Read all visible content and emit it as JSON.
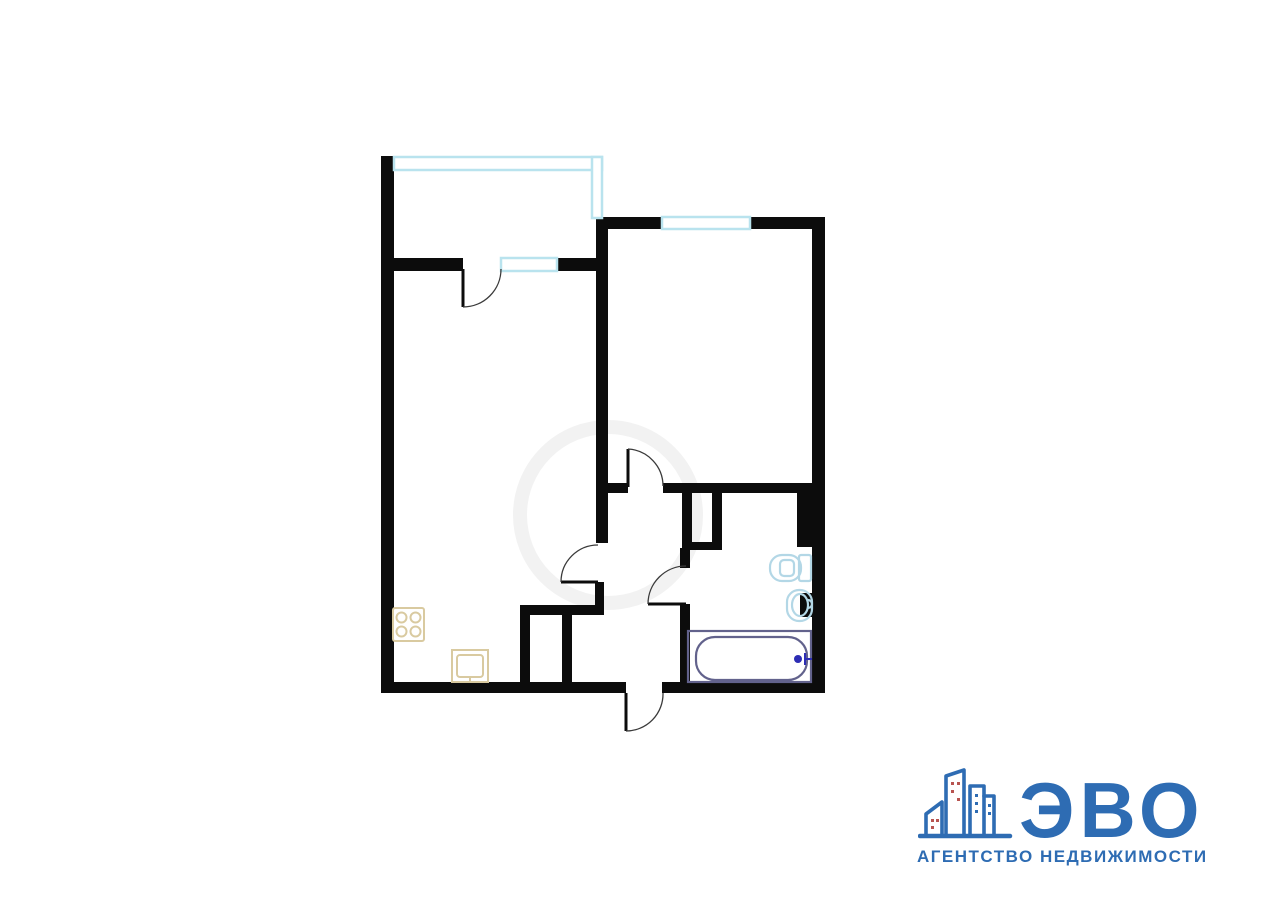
{
  "colors": {
    "background": "#ffffff",
    "wall": "#0c0c0c",
    "window": "#b9e3ee",
    "door_arc": "#3a3a3a",
    "bath_fixture": "#b3d7e6",
    "tub": "#62628c",
    "tub_accent": "#2d2db4",
    "kitchen_fixture": "#d9caa0",
    "logo_blue": "#2e6cb3",
    "logo_red": "#b85450",
    "watermark": "#f2f2f2"
  },
  "floor_plan": {
    "canvas": {
      "width": 1280,
      "height": 905
    },
    "walls": [
      {
        "n": "left-wall",
        "r": [
          381,
          156,
          13,
          536
        ]
      },
      {
        "n": "bottom-wall-left",
        "r": [
          381,
          682,
          245,
          11
        ]
      },
      {
        "n": "bottom-wall-right",
        "r": [
          662,
          682,
          163,
          11
        ]
      },
      {
        "n": "right-wall",
        "r": [
          812,
          217,
          13,
          476
        ]
      },
      {
        "n": "bedroom-top-wall-left",
        "r": [
          596,
          217,
          66,
          12
        ]
      },
      {
        "n": "bedroom-top-wall-right",
        "r": [
          750,
          217,
          75,
          12
        ]
      },
      {
        "n": "balcony-block-wall-left",
        "r": [
          381,
          258,
          82,
          13
        ]
      },
      {
        "n": "balcony-block-wall-right",
        "r": [
          557,
          258,
          51,
          13
        ]
      },
      {
        "n": "kitchen-bedroom-wall",
        "r": [
          596,
          229,
          12,
          314
        ]
      },
      {
        "n": "kitchen-door-jamb",
        "r": [
          595,
          582,
          9,
          33
        ]
      },
      {
        "n": "closet-top-wall",
        "r": [
          520,
          605,
          83,
          10
        ]
      },
      {
        "n": "closet-left-wall",
        "r": [
          520,
          615,
          10,
          68
        ]
      },
      {
        "n": "closet-mid-wall",
        "r": [
          562,
          615,
          10,
          68
        ]
      },
      {
        "n": "bedroom-bottom-wall-left",
        "r": [
          596,
          483,
          32,
          10
        ]
      },
      {
        "n": "bedroom-bottom-wall-right",
        "r": [
          663,
          483,
          149,
          10
        ]
      },
      {
        "n": "shaft-left-wall",
        "r": [
          682,
          493,
          10,
          57
        ]
      },
      {
        "n": "shaft-right-wall",
        "r": [
          712,
          493,
          10,
          57
        ]
      },
      {
        "n": "shaft-bottom-wall",
        "r": [
          682,
          542,
          40,
          8
        ]
      },
      {
        "n": "bathroom-wall-stub",
        "r": [
          680,
          548,
          10,
          20
        ]
      },
      {
        "n": "bathroom-left-wall",
        "r": [
          680,
          604,
          10,
          79
        ]
      },
      {
        "n": "bathroom-pilaster-upper",
        "r": [
          797,
          488,
          15,
          59
        ]
      },
      {
        "n": "bathroom-pilaster-lower",
        "r": [
          800,
          593,
          12,
          24
        ]
      }
    ],
    "windows": [
      {
        "n": "balcony-glazing-top",
        "r": [
          394,
          157,
          208,
          13
        ]
      },
      {
        "n": "balcony-glazing-right",
        "r": [
          592,
          157,
          10,
          61
        ]
      },
      {
        "n": "kitchen-window",
        "r": [
          501,
          258,
          56,
          13
        ]
      },
      {
        "n": "bedroom-window",
        "r": [
          662,
          217,
          88,
          12
        ]
      }
    ],
    "doors": [
      {
        "n": "balcony-door",
        "leaf": [
          463,
          269,
          463,
          307
        ],
        "arc": "M463,307 A38,38 0 0 0 501,269"
      },
      {
        "n": "bedroom-door",
        "leaf": [
          628,
          449,
          628,
          487
        ],
        "arc": "M628,449 A37,37 0 0 1 663,486"
      },
      {
        "n": "living-room-door",
        "leaf": [
          561,
          582,
          598,
          582
        ],
        "arc": "M561,582 A37,37 0 0 1 598,545"
      },
      {
        "n": "bathroom-door",
        "leaf": [
          648,
          604,
          686,
          604
        ],
        "arc": "M648,604 A38,38 0 0 1 686,566"
      },
      {
        "n": "entrance-door",
        "leaf": [
          626,
          693,
          626,
          731
        ],
        "arc": "M626,731 A37,37 0 0 0 663,693"
      }
    ],
    "fixtures": [
      "stove",
      "kitchen-sink",
      "toilet",
      "bathroom-sink",
      "bathtub"
    ]
  },
  "logo": {
    "title": "ЭВО",
    "subtitle": "АГЕНТСТВО НЕДВИЖИМОСТИ"
  }
}
